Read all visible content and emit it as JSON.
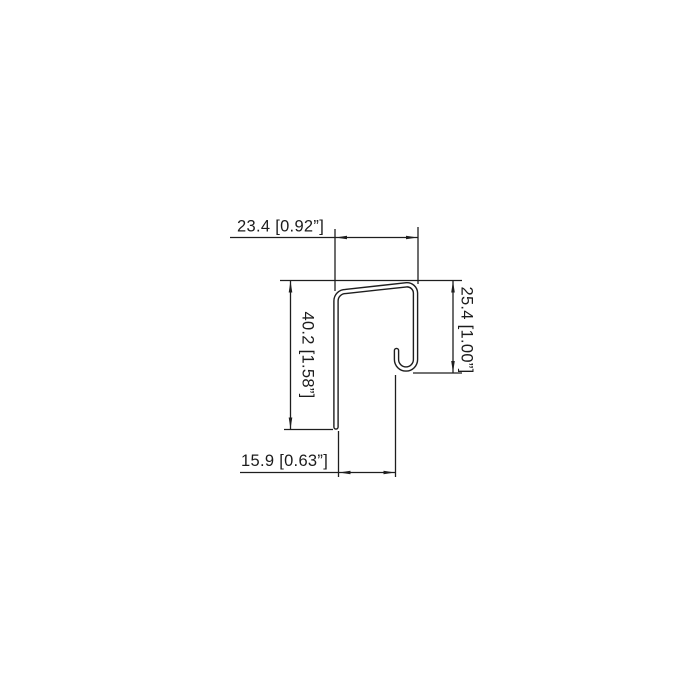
{
  "page": {
    "background_color": "#ffffff",
    "line_color": "#1e1e1e"
  },
  "drawing": {
    "kind": "sheet-metal j-profile cross-section, dimensioned CAD drawing",
    "units": "mm [inch]",
    "dimensions": {
      "top_width": {
        "label": "23.4 [0.92”]",
        "mm": "23.4",
        "inch": "0.92”"
      },
      "left_height": {
        "label": "40.2 [1.58”]",
        "mm": "40.2",
        "inch": "1.58”"
      },
      "right_height": {
        "label": "25.4 [1.00”]",
        "mm": "25.4",
        "inch": "1.00”"
      },
      "bottom_width": {
        "label": "15.9 [0.63”]",
        "mm": "15.9",
        "inch": "0.63”"
      }
    }
  }
}
